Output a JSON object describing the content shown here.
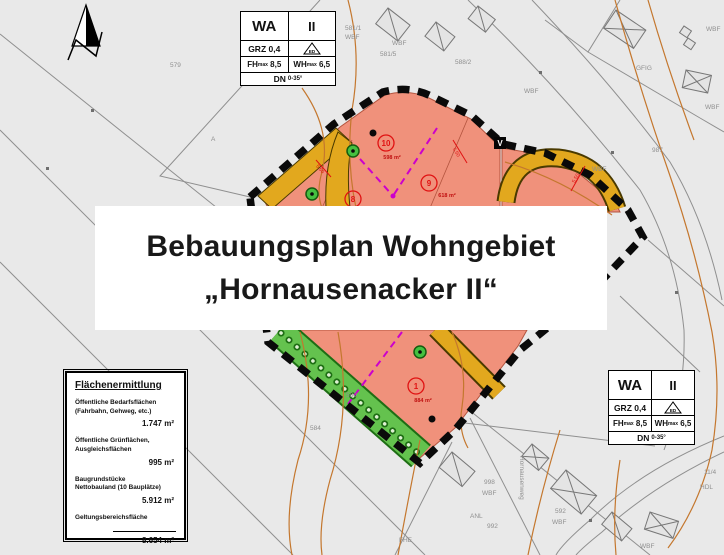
{
  "title_banner": {
    "line1": "Bebauungsplan Wohngebiet",
    "line2": "„Hornausenacker II“"
  },
  "wa_box": {
    "zone": "WA",
    "storeys": "II",
    "grz": "GRZ 0,4",
    "ed": "ED",
    "fh_label": "FH",
    "max_sub": "max",
    "fh_value": "8,5",
    "wh_label": "WH",
    "wh_value": "6,5",
    "dn_label": "DN",
    "dn_value": "0-35°"
  },
  "area_table": {
    "title": "Flächenermittlung",
    "rows": [
      {
        "label": "Öffentliche Bedarfsflächen\n(Fahrbahn, Gehweg, etc.)",
        "value": "1.747 m²"
      },
      {
        "label": "Öffentliche Grünflächen,\nAusgleichsflächen",
        "value": "995 m²"
      },
      {
        "label": "Baugrundstücke\nNettobauland (10 Bauplätze)",
        "value": "5.912 m²"
      },
      {
        "label": "Geltungsbereichsfläche",
        "value": "8.654 m²"
      }
    ]
  },
  "plots": [
    {
      "num": "10",
      "area": "598 m²"
    },
    {
      "num": "9",
      "area": "618 m²"
    },
    {
      "num": "8",
      "area": ""
    },
    {
      "num": "1",
      "area": "884 m²"
    }
  ],
  "markers": {
    "v": "V",
    "dim": "5,50"
  },
  "map_labels": [
    {
      "text": "579"
    },
    {
      "text": "A"
    },
    {
      "text": "581/1"
    },
    {
      "text": "WBF"
    },
    {
      "text": "WBF"
    },
    {
      "text": "581/5"
    },
    {
      "text": "588/2"
    },
    {
      "text": "GFIG"
    },
    {
      "text": "WBF"
    },
    {
      "text": "WBF"
    },
    {
      "text": "WBF"
    },
    {
      "text": "WBF"
    },
    {
      "text": "987"
    },
    {
      "text": "11/4"
    },
    {
      "text": "HDL"
    },
    {
      "text": "998"
    },
    {
      "text": "WBF"
    },
    {
      "text": "ANL"
    },
    {
      "text": "992"
    },
    {
      "text": "FHE"
    },
    {
      "text": "592"
    },
    {
      "text": "WBF"
    },
    {
      "text": "584"
    },
    {
      "text": "580"
    },
    {
      "text": "WBF"
    },
    {
      "text": "Hornausenweg"
    }
  ],
  "colors": {
    "background": "#e9e9e9",
    "parcel_fill": "#f0917b",
    "road_fill": "#e2a81e",
    "green_fill": "#64c24e",
    "boundary_dash": "#0a0a0a",
    "divider_magenta": "#cc00cc",
    "contour_orange": "#c4772e",
    "marker_red": "#e01212"
  }
}
